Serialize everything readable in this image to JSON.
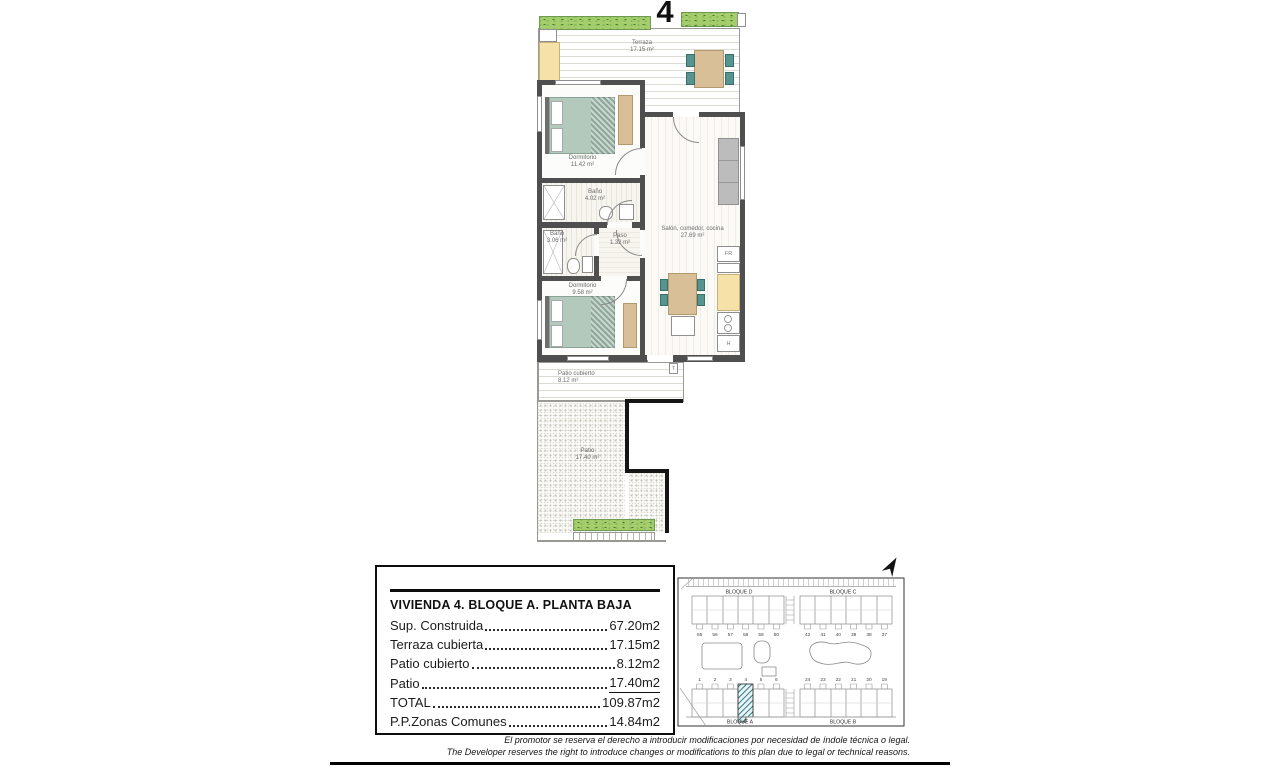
{
  "page": {
    "plan_number": "4",
    "disclaimer_es": "El promotor se reserva el derecho a introducir modificaciones por necesidad de índole técnica o legal.",
    "disclaimer_en": "The Developer reserves the right to introduce changes or modifications to this plan due to legal or technical reasons."
  },
  "floorplan": {
    "rooms": {
      "terraza": {
        "name": "Terraza",
        "area": "17.15 m²"
      },
      "dormitorio1": {
        "name": "Dormitorio",
        "area": "11.42 m²"
      },
      "bano1": {
        "name": "Baño",
        "area": "4.02 m²"
      },
      "bano2": {
        "name": "Baño",
        "area": "3.06 m²"
      },
      "paso": {
        "name": "Paso",
        "area": "1.32 m²"
      },
      "dormitorio2": {
        "name": "Dormitorio",
        "area": "9.58 m²"
      },
      "salon": {
        "name": "Salón, comedor, cocina",
        "area": "27.69 m²"
      },
      "patio_cubierto": {
        "name": "Patio cubierto",
        "area": "8.12 m²"
      },
      "patio": {
        "name": "Patio",
        "area": "17.40 m²"
      }
    },
    "markers": {
      "fridge": "FR",
      "hob": "H",
      "tube": "T"
    }
  },
  "infobox": {
    "title": "VIVIENDA 4. BLOQUE A. PLANTA BAJA",
    "rows": [
      {
        "label": "Sup. Construida",
        "value": "67.20m2"
      },
      {
        "label": "Terraza cubierta",
        "value": "17.15m2"
      },
      {
        "label": "Patio cubierto",
        "value": "8.12m2"
      },
      {
        "label": "Patio",
        "value": "17.40m2"
      },
      {
        "label": "TOTAL",
        "value": "109.87m2"
      },
      {
        "label": "P.P.Zonas Comunes",
        "value": "14.84m2"
      }
    ]
  },
  "siteplan": {
    "block_top_left": "BLOQUE D",
    "block_top_right": "BLOQUE C",
    "block_bottom_left": "BLOQUE A",
    "block_bottom_right": "BLOQUE B",
    "top_left_units": [
      "55",
      "56",
      "57",
      "58",
      "59",
      "60"
    ],
    "top_right_units": [
      "42",
      "41",
      "40",
      "39",
      "38",
      "37"
    ],
    "bottom_left_units": [
      "1",
      "2",
      "3",
      "4",
      "5",
      "6"
    ],
    "bottom_right_units": [
      "24",
      "23",
      "22",
      "21",
      "20",
      "19"
    ],
    "highlighted_unit": "4"
  },
  "colors": {
    "hedge_green": "#a6cd6c",
    "furniture_teal": "#57948f",
    "bed_sage": "#b2c9bc",
    "wood_tan": "#d8bf98",
    "counter_yellow": "#f6e2a8",
    "wall_gray": "#4f4f4f",
    "highlight_hatch": "#2e7c8a"
  }
}
